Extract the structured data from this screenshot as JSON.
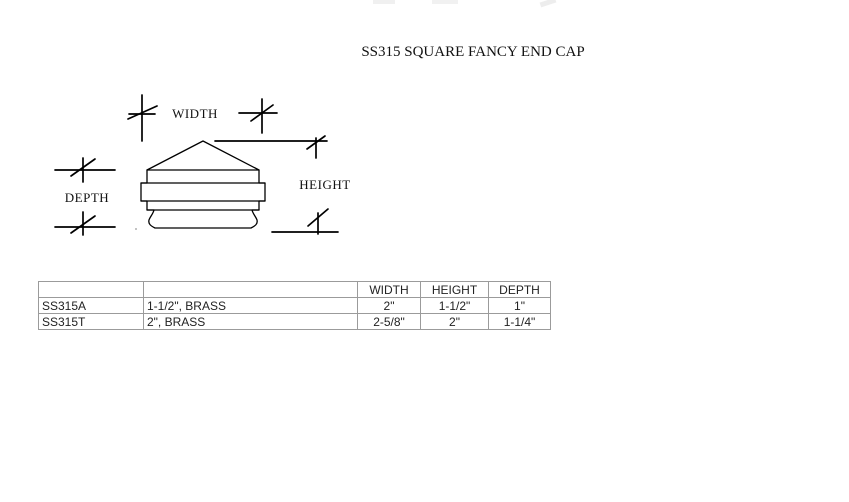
{
  "page": {
    "title": "SS315 SQUARE FANCY END CAP"
  },
  "diagram": {
    "labels": {
      "width": "WIDTH",
      "height": "HEIGHT",
      "depth": "DEPTH"
    }
  },
  "table": {
    "headers": [
      "",
      "",
      "WIDTH",
      "HEIGHT",
      "DEPTH"
    ],
    "rows": [
      [
        "SS315A",
        "1-1/2\", BRASS",
        "2\"",
        "1-1/2\"",
        "1\""
      ],
      [
        "SS315T",
        "2\", BRASS",
        "2-5/8\"",
        "2\"",
        "1-1/4\""
      ]
    ]
  },
  "colors": {
    "line": "#000000",
    "table_border": "#9b9b9b",
    "text": "#1a1a1a",
    "background": "#ffffff"
  }
}
